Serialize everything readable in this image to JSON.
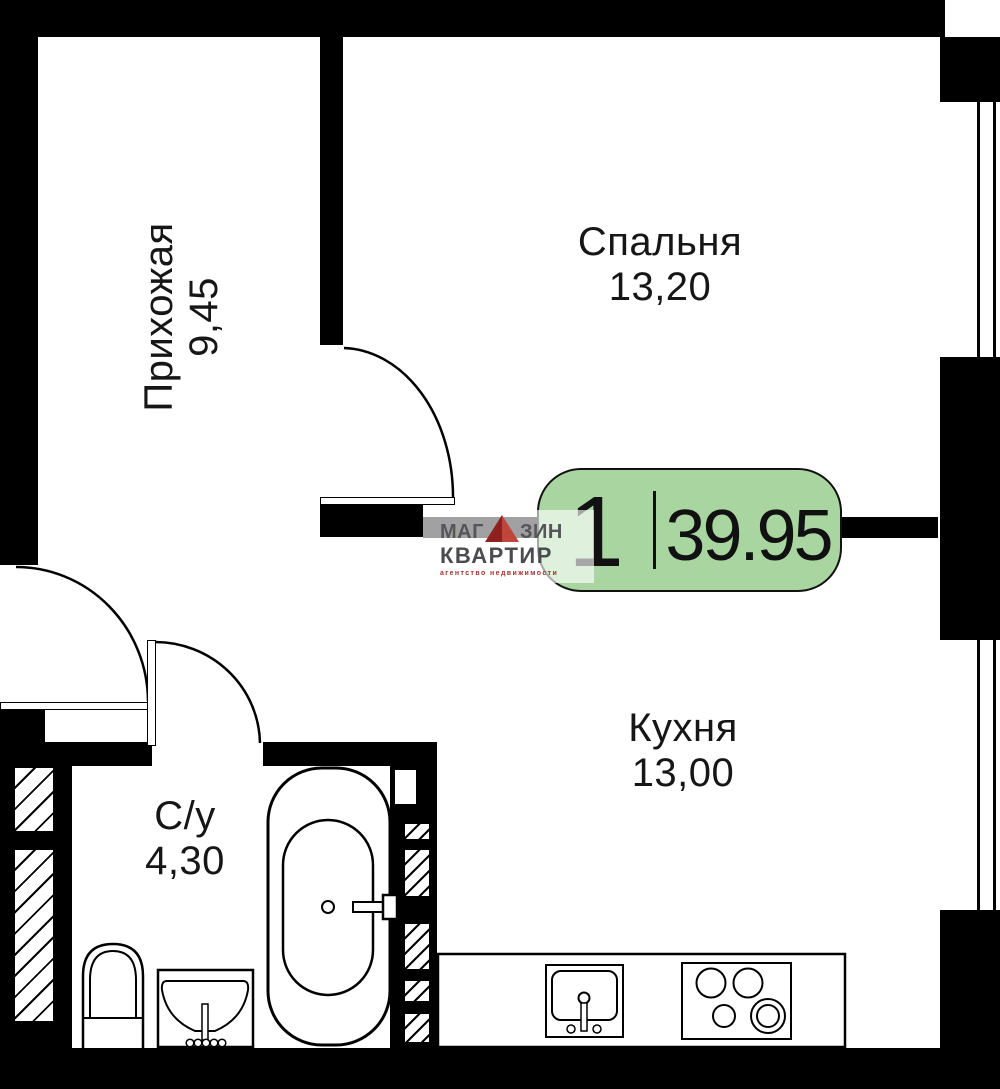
{
  "brand": {
    "word1_left": "МАГ",
    "word1_right": "ЗИН",
    "word2": "КВАРТИР",
    "tagline": "агентство недвижимости"
  },
  "badge": {
    "rooms_count": "1",
    "total_area": "39.95"
  },
  "rooms": {
    "hallway": {
      "name": "Прихожая",
      "area": "9,45"
    },
    "bedroom": {
      "name": "Спальня",
      "area": "13,20"
    },
    "kitchen": {
      "name": "Кухня",
      "area": "13,00"
    },
    "bathroom": {
      "name": "С/у",
      "area": "4,30"
    }
  },
  "colors": {
    "wall": "#000000",
    "badge_green": "#a9d5a1",
    "logo_gray": "#55555a",
    "logo_red": "#a2342c"
  }
}
